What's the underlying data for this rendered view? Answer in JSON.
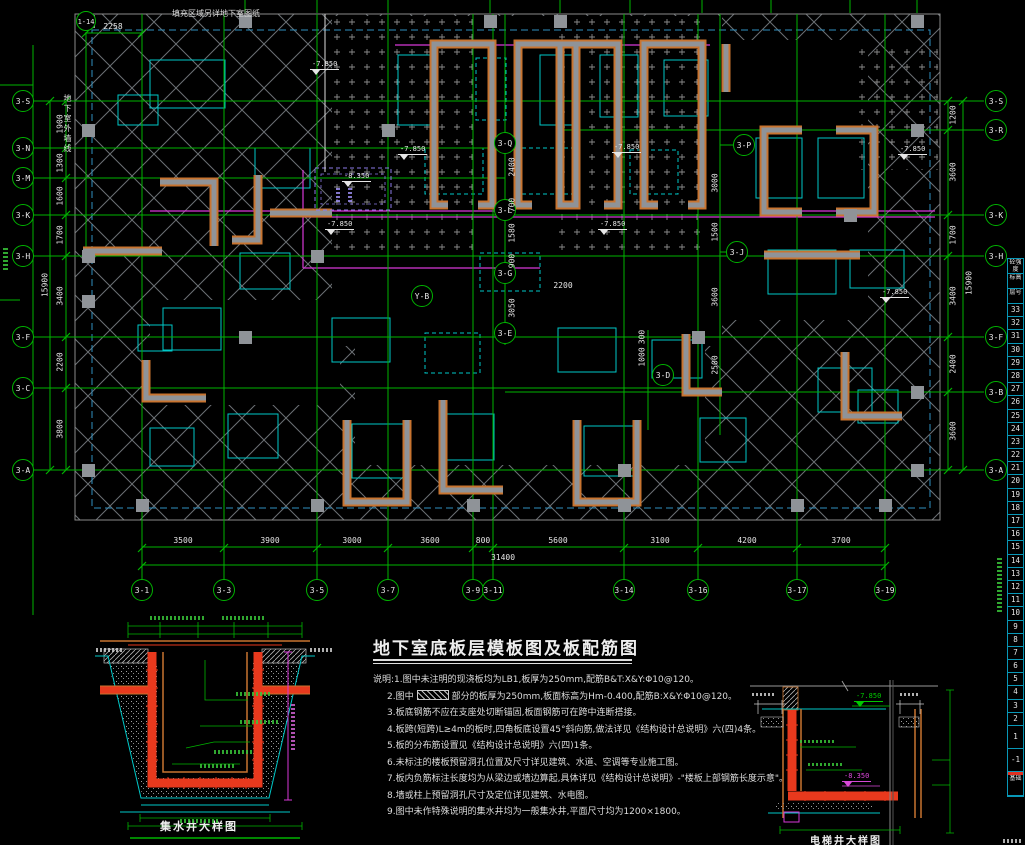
{
  "title": {
    "text": "地下室底板层模板图及板配筋图"
  },
  "notes": {
    "l1": "说明:1.图中未注明的现浇板均为LB1,板厚为250mm,配筋B&T:X&Y:Φ10@120。",
    "l2_pre": "2.图中",
    "l2_post": "部分的板厚为250mm,板面标高为Hm-0.400,配筋B:X&Y:Φ10@120。",
    "l3": "3.板底钢筋不应在支座处切断锚固,板面钢筋可在跨中连断搭接。",
    "l4": "4.板跨(短跨)L≥4m的板时,四角板底设置45°斜向筋,做法详见《结构设计总说明》六(四)4条。",
    "l5": "5.板的分布筋设置见《结构设计总说明》六(四)1条。",
    "l6": "6.未标注的楼板预留洞孔位置及尺寸详见建筑、水道、空调等专业施工图。",
    "l7": "7.板内负筋标注长度均为从梁边或墙边算起,具体详见《结构设计总说明》-\"楼板上部钢筋长度示意\"。",
    "l8": "8.墙或柱上预留洞孔尺寸及定位详见建筑、水电图。",
    "l9": "9.图中未作特殊说明的集水井均为一般集水井,平面尺寸均为1200×1800。"
  },
  "topnote": {
    "text": "填充区域另详地下室图纸"
  },
  "vlabel": {
    "text": "地下室外墙线"
  },
  "axes": {
    "left": [
      {
        "t": "3-S",
        "x": 23,
        "y": 101
      },
      {
        "t": "3-N",
        "x": 23,
        "y": 148
      },
      {
        "t": "3-M",
        "x": 23,
        "y": 178
      },
      {
        "t": "3-K",
        "x": 23,
        "y": 215
      },
      {
        "t": "3-H",
        "x": 23,
        "y": 256
      },
      {
        "t": "3-F",
        "x": 23,
        "y": 337
      },
      {
        "t": "3-C",
        "x": 23,
        "y": 388
      },
      {
        "t": "3-A",
        "x": 23,
        "y": 470
      }
    ],
    "right": [
      {
        "t": "3-S",
        "x": 996,
        "y": 101
      },
      {
        "t": "3-R",
        "x": 996,
        "y": 130
      },
      {
        "t": "3-K",
        "x": 996,
        "y": 215
      },
      {
        "t": "3-H",
        "x": 996,
        "y": 256
      },
      {
        "t": "3-F",
        "x": 996,
        "y": 337
      },
      {
        "t": "3-B",
        "x": 996,
        "y": 392
      },
      {
        "t": "3-A",
        "x": 996,
        "y": 470
      }
    ],
    "bottom": [
      {
        "t": "3-1",
        "x": 142,
        "y": 590
      },
      {
        "t": "3-3",
        "x": 224,
        "y": 590
      },
      {
        "t": "3-5",
        "x": 317,
        "y": 590
      },
      {
        "t": "3-7",
        "x": 388,
        "y": 590
      },
      {
        "t": "3-9",
        "x": 473,
        "y": 590
      },
      {
        "t": "3-11",
        "x": 493,
        "y": 590
      },
      {
        "t": "3-14",
        "x": 624,
        "y": 590
      },
      {
        "t": "3-16",
        "x": 698,
        "y": 590
      },
      {
        "t": "3-17",
        "x": 797,
        "y": 590
      },
      {
        "t": "3-19",
        "x": 885,
        "y": 590
      }
    ],
    "inner": [
      {
        "t": "3-Q",
        "x": 505,
        "y": 143
      },
      {
        "t": "3-L",
        "x": 505,
        "y": 210
      },
      {
        "t": "3-G",
        "x": 505,
        "y": 273
      },
      {
        "t": "3-E",
        "x": 505,
        "y": 333
      },
      {
        "t": "3-P",
        "x": 744,
        "y": 145
      },
      {
        "t": "3-J",
        "x": 737,
        "y": 252
      },
      {
        "t": "3-D",
        "x": 663,
        "y": 375
      },
      {
        "t": "Y-B",
        "x": 422,
        "y": 296
      }
    ],
    "extra": [
      {
        "t": "1-14",
        "x": 86,
        "y": 21
      }
    ]
  },
  "dims": {
    "leftv": [
      {
        "t": "1900",
        "y": 124
      },
      {
        "t": "1300",
        "y": 163
      },
      {
        "t": "1600",
        "y": 196
      },
      {
        "t": "1700",
        "y": 235
      },
      {
        "t": "3400",
        "y": 296
      },
      {
        "t": "2200",
        "y": 362
      },
      {
        "t": "3800",
        "y": 429
      }
    ],
    "left_total": {
      "t": "15900",
      "x": 45,
      "y": 285
    },
    "rightv": [
      {
        "t": "1200",
        "y": 115
      },
      {
        "t": "3600",
        "y": 172
      },
      {
        "t": "1700",
        "y": 235
      },
      {
        "t": "3400",
        "y": 296
      },
      {
        "t": "2400",
        "y": 364
      },
      {
        "t": "3600",
        "y": 431
      }
    ],
    "right_total": {
      "t": "15900",
      "x": 969,
      "y": 283
    },
    "bottom": [
      {
        "t": "3500",
        "x": 183
      },
      {
        "t": "3900",
        "x": 270
      },
      {
        "t": "3000",
        "x": 352
      },
      {
        "t": "3600",
        "x": 430
      },
      {
        "t": "800",
        "x": 483
      },
      {
        "t": "5600",
        "x": 558
      },
      {
        "t": "3100",
        "x": 660
      },
      {
        "t": "4200",
        "x": 747
      },
      {
        "t": "3700",
        "x": 841
      }
    ],
    "bottom_total": {
      "t": "31400",
      "x": 503,
      "y": 562
    },
    "top": {
      "t": "2258",
      "x": 113,
      "y": 31
    },
    "innerv": [
      {
        "t": "2400",
        "x": 512,
        "y": 167
      },
      {
        "t": "700",
        "x": 512,
        "y": 205
      },
      {
        "t": "1580",
        "x": 512,
        "y": 233
      },
      {
        "t": "900",
        "x": 512,
        "y": 261
      },
      {
        "t": "3050",
        "x": 512,
        "y": 308
      },
      {
        "t": "3000",
        "x": 715,
        "y": 183
      },
      {
        "t": "1500",
        "x": 715,
        "y": 232
      },
      {
        "t": "3600",
        "x": 715,
        "y": 297
      },
      {
        "t": "2500",
        "x": 715,
        "y": 365
      },
      {
        "t": "300",
        "x": 642,
        "y": 337
      },
      {
        "t": "1000",
        "x": 642,
        "y": 357
      }
    ],
    "innerh": [
      {
        "t": "2200",
        "x": 563,
        "y": 290
      }
    ]
  },
  "elevations": [
    {
      "t": "-7.850",
      "x": 310,
      "y": 60,
      "c": "w"
    },
    {
      "t": "-7.850",
      "x": 398,
      "y": 145,
      "c": "w"
    },
    {
      "t": "-7.850",
      "x": 612,
      "y": 143,
      "c": "w"
    },
    {
      "t": "-7.850",
      "x": 898,
      "y": 145,
      "c": "w"
    },
    {
      "t": "-7.850",
      "x": 325,
      "y": 220,
      "c": "w"
    },
    {
      "t": "-7.850",
      "x": 598,
      "y": 220,
      "c": "w"
    },
    {
      "t": "-7.850",
      "x": 880,
      "y": 288,
      "c": "w"
    },
    {
      "t": "-8.350",
      "x": 342,
      "y": 172,
      "c": "w"
    },
    {
      "t": "-7.850",
      "x": 854,
      "y": 692,
      "c": "g"
    },
    {
      "t": "-8.350",
      "x": 842,
      "y": 772,
      "c": "m"
    }
  ],
  "details": {
    "sump_caption": "集水井大样图",
    "elevator_caption": "电梯井大样图"
  },
  "floor_strip": {
    "headers": [
      "砼强度",
      "标高",
      "层号"
    ],
    "numbers": [
      "33",
      "32",
      "31",
      "30",
      "29",
      "28",
      "27",
      "26",
      "25",
      "24",
      "23",
      "22",
      "21",
      "20",
      "19",
      "18",
      "17",
      "16",
      "15",
      "14",
      "13",
      "12",
      "11",
      "10",
      "9",
      "8",
      "7",
      "6",
      "5",
      "4",
      "3",
      "2"
    ],
    "ground": "1",
    "basement": "-1",
    "footer": "基础"
  },
  "colors": {
    "grid_green": "#00b400",
    "slab_cyan": "#00c8c8",
    "beam_magenta": "#d838d8",
    "wall_edge_orange": "#c87430",
    "wall_gray": "#8f9398",
    "rebar_red": "#e8391d",
    "pit_purple": "#8b7ae8",
    "hatch_gray": "#72777b",
    "text_white": "#e6e6e6",
    "level_red": "#e03020"
  }
}
